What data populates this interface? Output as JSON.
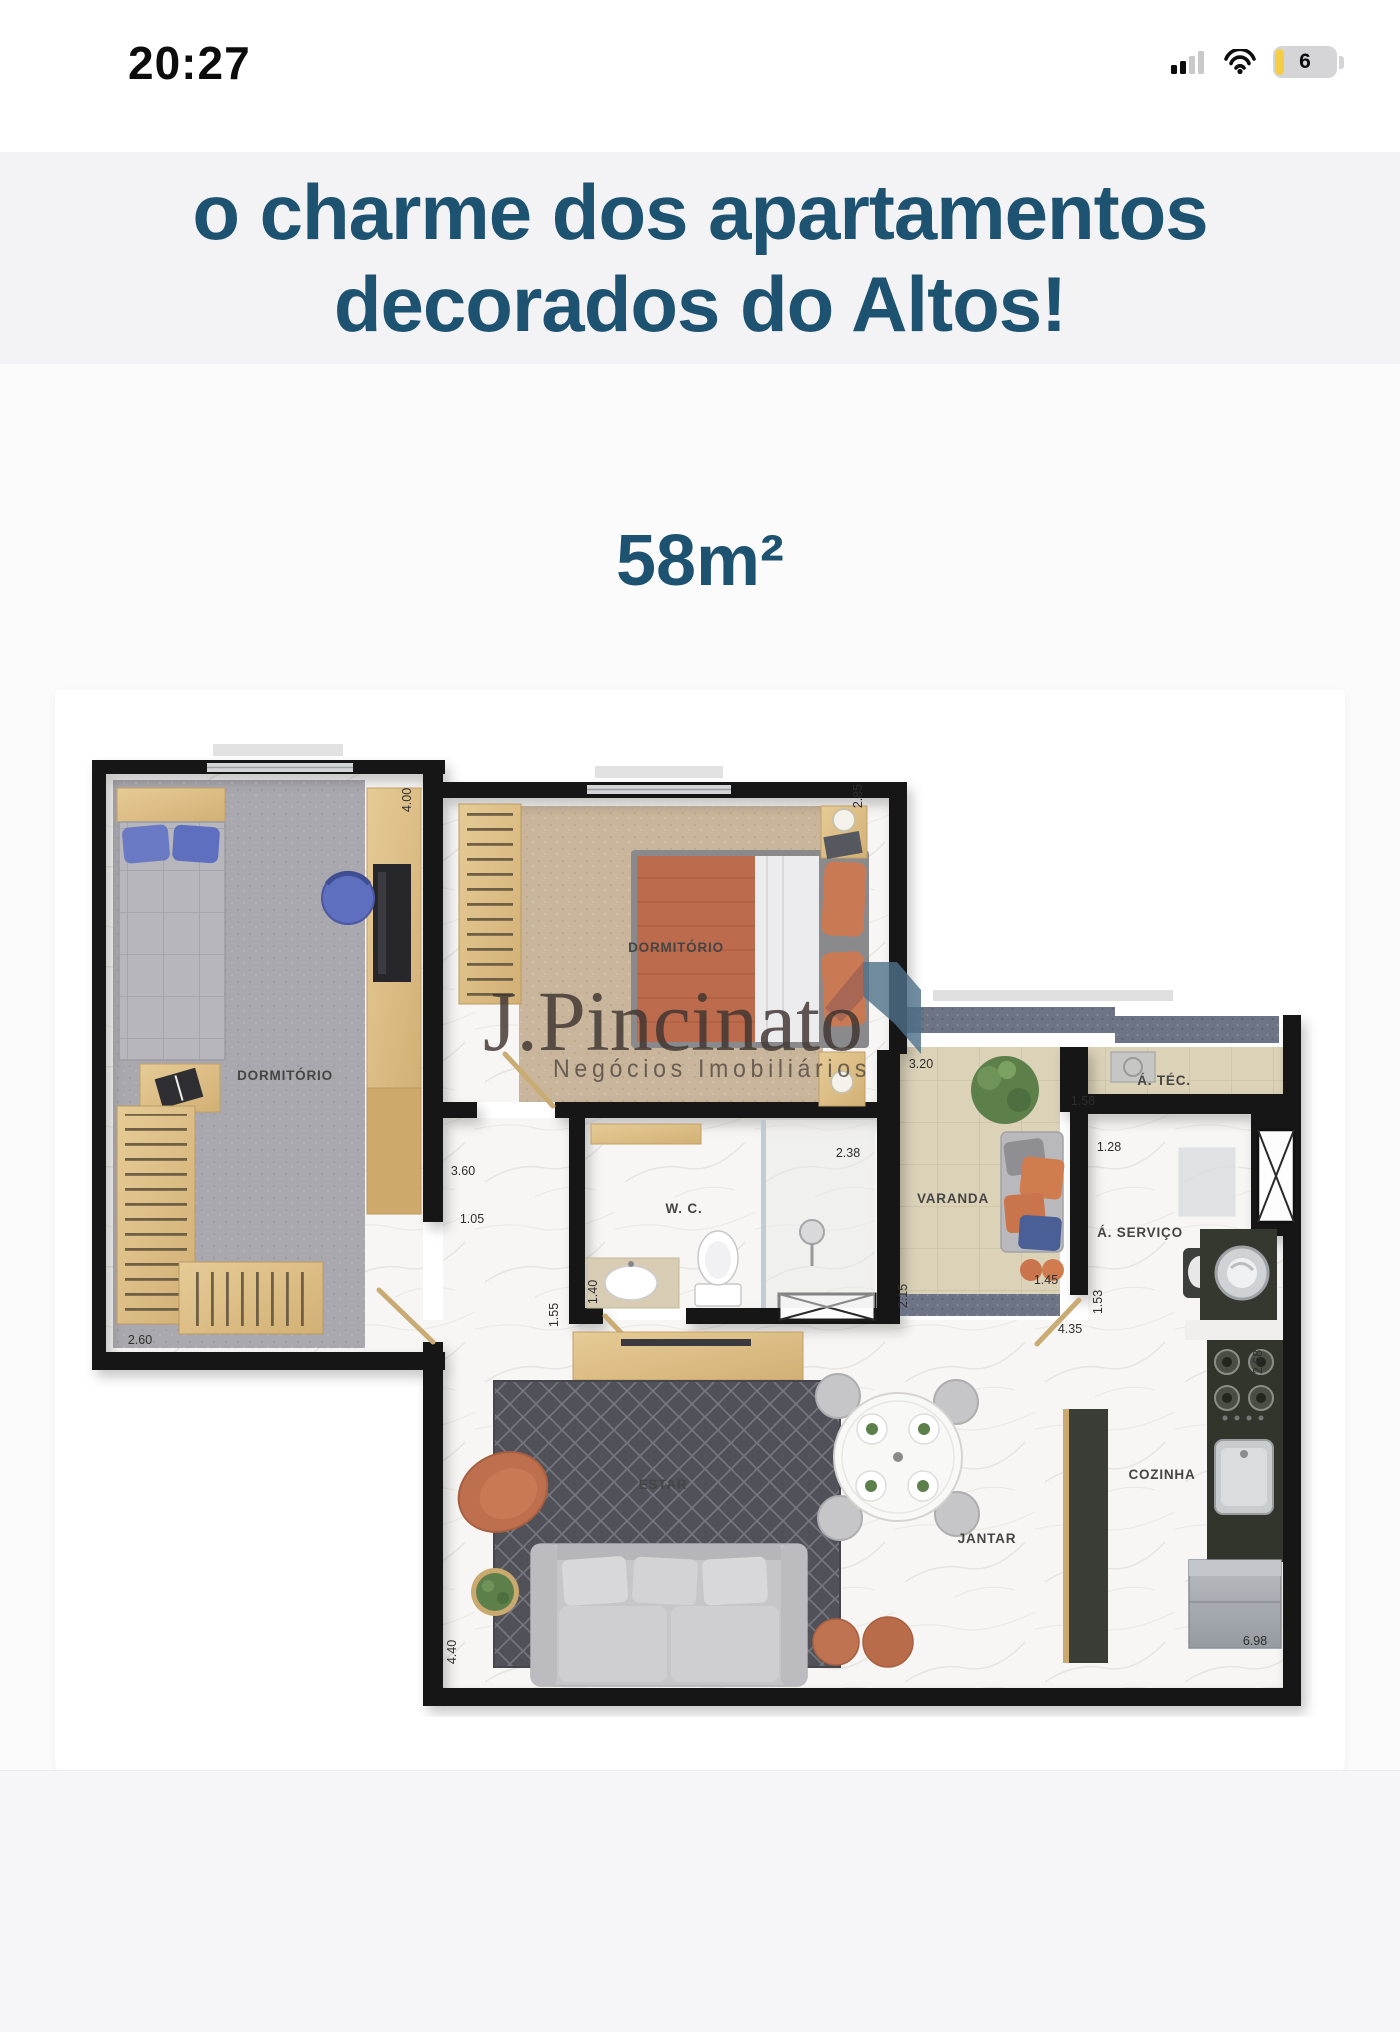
{
  "status_bar": {
    "time": "20:27",
    "battery_level": "6"
  },
  "headline": {
    "line1": "o charme dos apartamentos",
    "line2": "decorados do Altos!"
  },
  "area_label": "58m²",
  "watermark": {
    "brand": "J.Pincinato",
    "tagline": "Negócios Imobiliários"
  },
  "floor_plan": {
    "rooms": {
      "bedroom1": "DORMITÓRIO",
      "bedroom2": "DORMITÓRIO",
      "wc": "W. C.",
      "balcony": "VARANDA",
      "technical": "Á. TÉC.",
      "service": "Á. SERVIÇO",
      "living": "ESTAR",
      "dining": "JANTAR",
      "kitchen": "COZINHA"
    },
    "dims": {
      "d400": "4.00",
      "d285": "2.85",
      "d260": "2.60",
      "d360": "3.60",
      "d105": "1.05",
      "d238": "2.38",
      "d140": "1.40",
      "d155": "1.55",
      "d320": "3.20",
      "d158": "1.58",
      "d128": "1.28",
      "d215": "2.15",
      "d145": "1.45",
      "d153": "1.53",
      "d435": "4.35",
      "d268": "2.68",
      "d698": "6.98",
      "d440": "4.40"
    }
  },
  "colors": {
    "accent_teal": "#1d5270",
    "wall": "#181818",
    "wood": "#dcbc84",
    "carpet_gray": "#a9a8ae",
    "carpet_tan": "#c9b59b",
    "tile_beige": "#dbd2b8",
    "rug_dark": "#515159",
    "terracotta": "#bf6f50",
    "logo_blue": "#4f7089",
    "battery_yellow": "#f6ce45"
  }
}
